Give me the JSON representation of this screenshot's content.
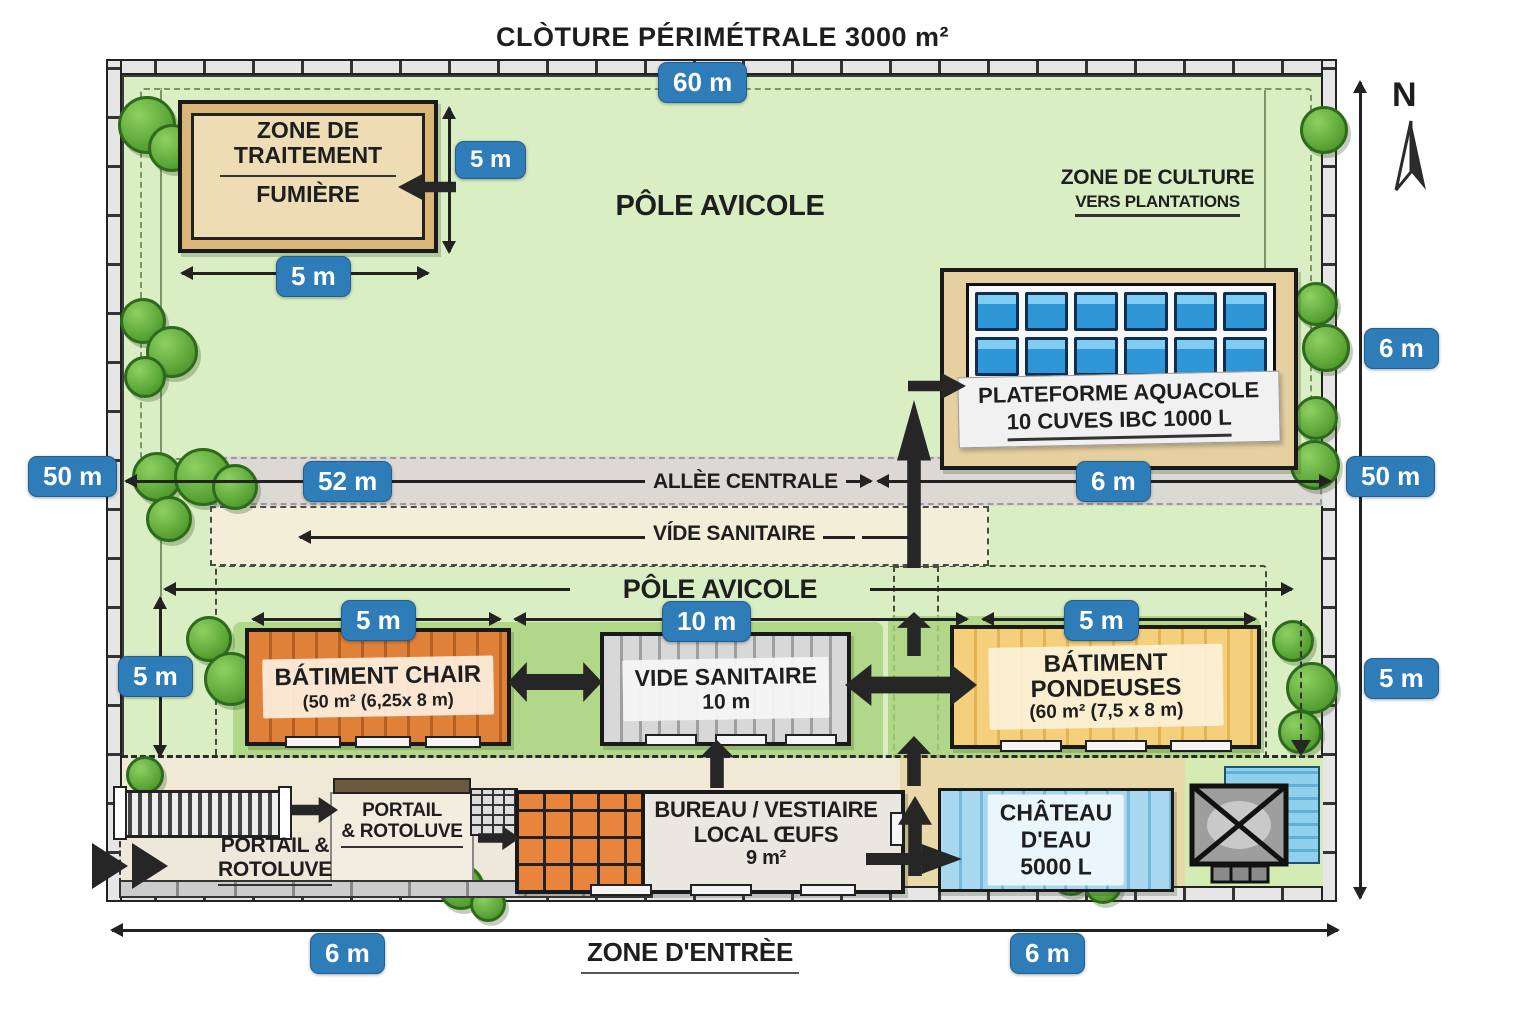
{
  "title": "CLÒTURE PÉRIMÉTRALE 3000 m²",
  "compass": {
    "north_label": "N"
  },
  "dimensions": {
    "top_width": "60 m",
    "left_height": "50 m",
    "right_height": "50 m",
    "right_upper": "6 m",
    "right_lower": "5 m",
    "fumiere_height": "5 m",
    "fumiere_width": "5 m",
    "allee_length": "52 m",
    "allee_right": "6 m",
    "row_left_height": "5 m",
    "chair_width": "5 m",
    "vide_width": "10 m",
    "pondeuses_width": "5 m",
    "bottom_left": "6 m",
    "bottom_right": "6 m"
  },
  "labels": {
    "pole_avicole_top": "PÔLE AVICOLE",
    "pole_avicole_mid": "PÔLE AVICOLE",
    "allee_centrale": "ALLÈE CENTRALE",
    "vide_sanitaire_strip": "VÍDE SANITAIRE",
    "zone_entree": "ZONE D'ENTRÈE"
  },
  "zones": {
    "fumiere": {
      "title": "ZONE DE TRAITEMENT",
      "subtitle": "FUMIÈRE"
    },
    "culture": {
      "title": "ZONE DE CULTURE",
      "subtitle": "VERS PLANTATIONS"
    },
    "aquacole": {
      "title": "PLATEFORME AQUACOLE",
      "subtitle": "10 CUVES IBC 1000 L"
    },
    "batiment_chair": {
      "title": "BÁTIMENT CHAIR",
      "subtitle": "(50 m² (6,25x 8 m)"
    },
    "vide_sanitaire_building": {
      "title": "VIDE SANITAIRE",
      "subtitle": "10 m"
    },
    "batiment_pondeuses": {
      "title": "BÁTIMENT PONDEUSES",
      "subtitle": "(60 m² (7,5 x 8 m)"
    },
    "portail_outer": {
      "line1": "PORTAIL &",
      "line2": "ROTOLUVE"
    },
    "portail_inner": {
      "line1": "PORTAIL",
      "line2": "& ROTOLUVE"
    },
    "bureau": {
      "line1": "BUREAU / VESTIAIRE",
      "line2": "LOCAL ŒUFS",
      "line3": "9 m²"
    },
    "chateau": {
      "line1": "CHÂTEAU",
      "line2": "D'EAU",
      "line3": "5000 L"
    }
  },
  "colors": {
    "badge_blue": "#2e7cb8",
    "grass_green": "#d9eec3",
    "building_orange": "#e0813a",
    "building_yellow": "#f4d07d",
    "water_blue": "#8fcbe9",
    "sand_tan": "#e6d0a0"
  }
}
